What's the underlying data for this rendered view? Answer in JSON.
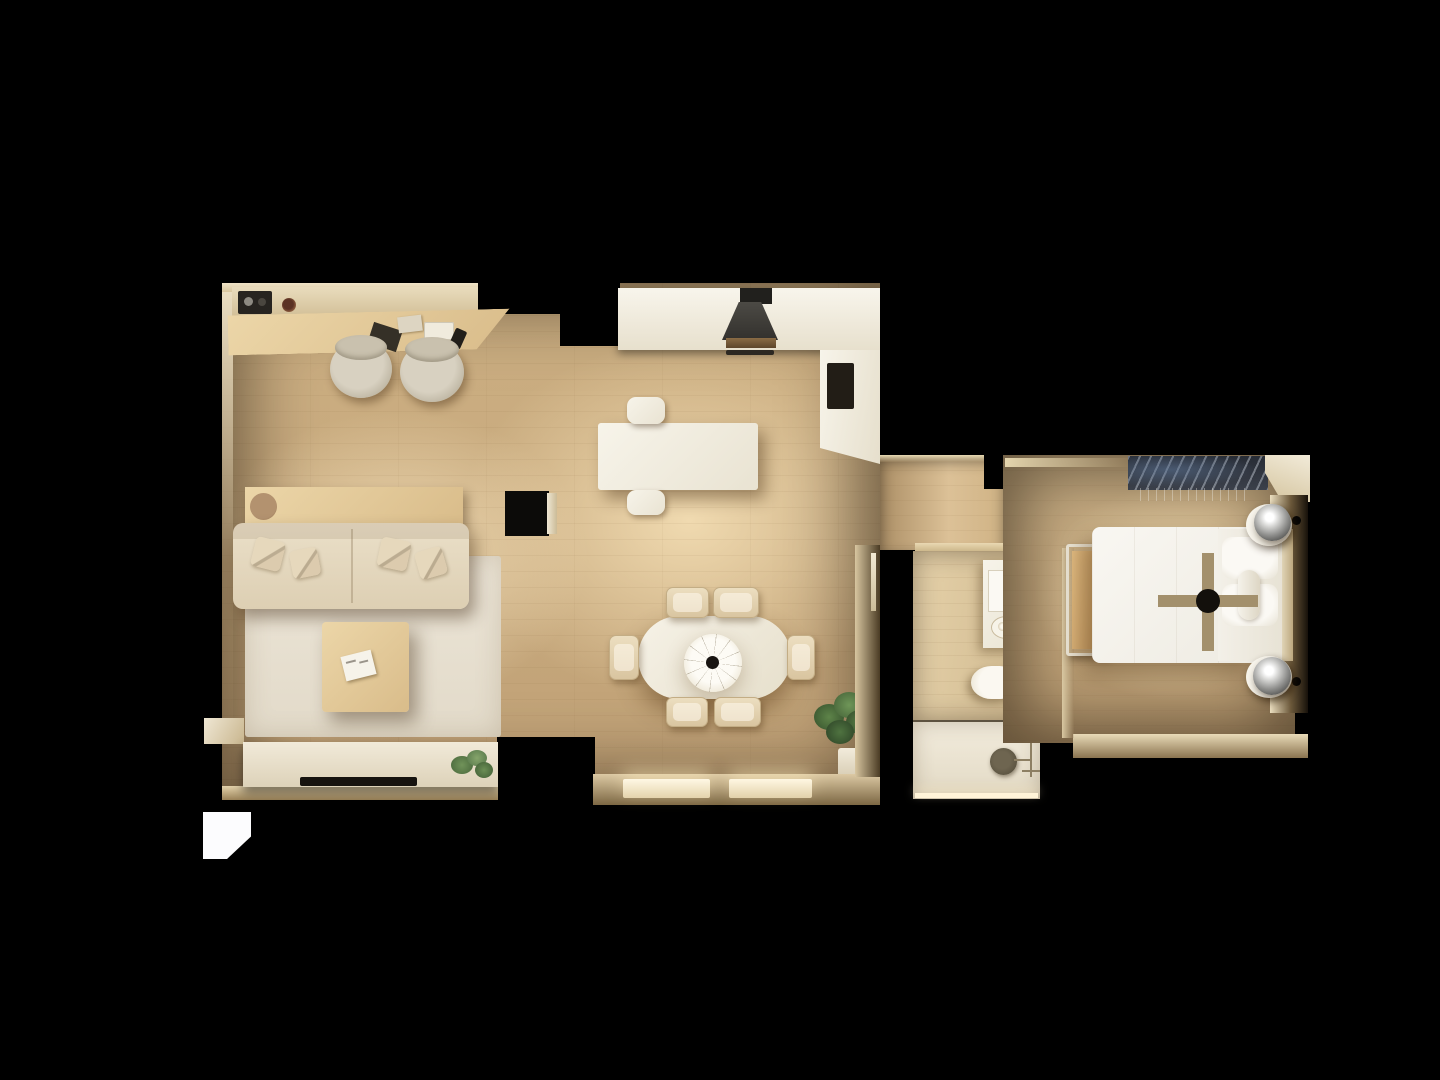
{
  "scene": {
    "description": "Top-down 3D architectural render of a one-bedroom apartment at night; warm lamplight pools on wood floors, unlit walls fade to a pure black background",
    "view": "top-down floor plan render",
    "background_color": "#000000",
    "palette": {
      "background": "#000000",
      "wood_floor": "#cdb083",
      "floor_highlight": "#f0dab0",
      "lit_wall": "#efe3c6",
      "white_furniture": "#f5f2e8",
      "wood_furniture": "#e2c99c",
      "sofa_beige": "#e5d8c0",
      "rug": "#e9e2d4",
      "dark_appliance": "#33312d",
      "plant_green": "#4f7c3d",
      "bed_white": "#f7f5f0",
      "bed_runner_tan": "#a3906c",
      "chrome_lamp": "#939391"
    },
    "rooms": [
      {
        "name": "home-office-nook",
        "items": [
          "wall shelf",
          "black speaker with two knobs",
          "coffee cup",
          "long wooden desk",
          "dark notebook",
          "paper sheets",
          "white laptop",
          "smartphone",
          "office chair",
          "office chair"
        ]
      },
      {
        "name": "living-room",
        "items": [
          "console table behind sofa",
          "round wooden tray",
          "three-seat beige sofa",
          "four throw pillows",
          "large light area rug",
          "square wooden coffee table",
          "open white magazine",
          "low white media sideboard",
          "flat TV lying on sideboard",
          "small potted plant",
          "black floor cabinet with white side"
        ]
      },
      {
        "name": "kitchen",
        "items": [
          "white wall counter",
          "dark range hood over cooktop",
          "oven handle",
          "tall white counter",
          "dark appliance inset",
          "white island table",
          "stool",
          "stool"
        ]
      },
      {
        "name": "dining-area",
        "items": [
          "oval white dining table",
          "white cone pendant lamp with dark finial",
          "dining chair top-left",
          "dining chair top-right",
          "dining chair bottom-left",
          "dining chair bottom-right",
          "dining chair left",
          "dining chair right",
          "large potted plant",
          "lit window sill left",
          "lit window sill right",
          "door in right wall"
        ]
      },
      {
        "name": "hallway",
        "items": [
          "opening to bedroom",
          "lit threshold to bathroom"
        ]
      },
      {
        "name": "bathroom",
        "items": [
          "white vanity",
          "mirror cabinet",
          "oval washbasin with two taps",
          "dark soap tray",
          "toilet with tank",
          "glass shower partition",
          "white shower tray",
          "round shower drain",
          "shower hose and mixer",
          "door swing arc"
        ]
      },
      {
        "name": "bedroom",
        "items": [
          "open clothes rail with hanging garments",
          "double bed with white duvet",
          "tan cross-shaped bed runner",
          "dark center disc on runner",
          "pillows",
          "slim headboard",
          "round nightstand top",
          "round nightstand bottom",
          "chrome sphere lamp top",
          "chrome sphere lamp bottom",
          "black wall spot top",
          "black wall spot bottom",
          "bench with tan seat",
          "lit bottom wall ledge"
        ]
      },
      {
        "name": "exterior",
        "items": [
          "bright white skylight patch lower left"
        ]
      }
    ],
    "lighting": [
      "warm pools of light at living and dining centers",
      "glowing window sills on the lower wall",
      "bright white angled patch outside lower-left wall",
      "all wall tops unlit black"
    ]
  }
}
